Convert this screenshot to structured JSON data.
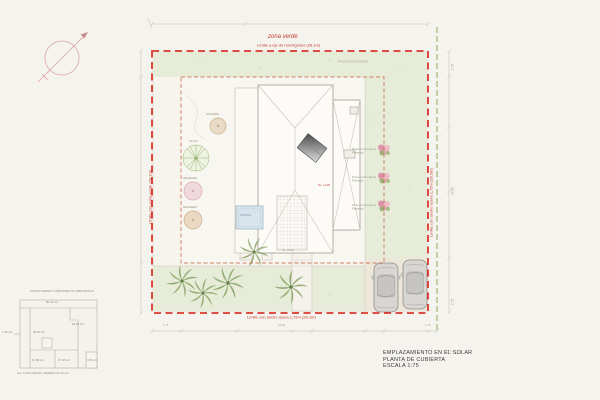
{
  "annotations": {
    "zona_verde": "zona verde",
    "limite_top": "Límite a eje de hormigones (28.1m)",
    "limite_bottom": "Límite con ancho acera 1,75m (28.1m)",
    "limite_right": "Límite con ancho acera 1,75m (28.5m)",
    "limite_left": "Límite con zona verde (28.1m)",
    "parcela_note": "Parcela urbanizadora",
    "nivel_roof": "Nv. +3.05",
    "nivel_ground": "Nv. ±0.00",
    "pool_label": "PISCINA"
  },
  "trees": {
    "higuera": "HIGUERA",
    "olivo": "OLIVO",
    "granado": "GRANADO",
    "noguera": "NOGUERA",
    "flowering_line1": "Prunus Con flores",
    "flowering_line2": "Pissardii"
  },
  "detail": {
    "title": "ZONAS VERDES CUMPLIMIENTO URBANISTICO",
    "area_top": "80.00 m2",
    "area_left": "48.29 m2",
    "area_left_outside": "7.98 m2",
    "area_right": "18.39 m2",
    "area_bottom_left": "62.88 m2",
    "area_bottom_mid": "37.08 m2",
    "area_bottom_right": "4.80 m2",
    "total": "sup. TOTAL ZONAS VERDES 235.16 m2"
  },
  "titleblock": {
    "line1": "EMPLAZAMIENTO EN EL SOLAR",
    "line2": "PLANTA DE CUBIERTA",
    "line3": "ESCALA 1:75"
  },
  "dims": {
    "bottom": [
      "1.75",
      "24.60",
      "1.75"
    ],
    "right": [
      "1.75",
      "24.95",
      "1.75"
    ]
  },
  "colors": {
    "boundary_red": "#d9372e",
    "setback_orange": "#c25a33",
    "green_zone": "#e7ecd9",
    "pool_blue": "#d7e4ec",
    "green_boundary": "#8aa85e"
  }
}
